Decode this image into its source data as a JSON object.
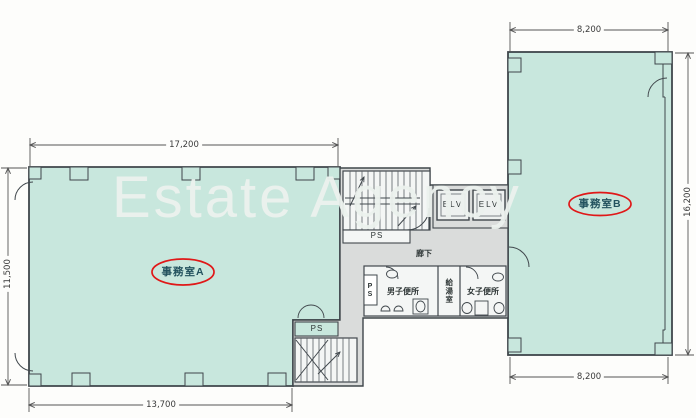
{
  "watermark": {
    "text": "Estate Agency"
  },
  "rooms": {
    "office_a": "事務室A",
    "office_b": "事務室B",
    "corridor": "廊下",
    "mens_toilet": "男子便所",
    "womens_toilet": "女子便所",
    "kitchenette": "給湯室",
    "elevator_1": "ELV",
    "elevator_2": "ELV",
    "pipe_shaft_stair": "PS",
    "pipe_shaft_toilet": "PS",
    "pipe_shaft_lower": "PS"
  },
  "dimensions": {
    "office_a_top_width": "17,200",
    "office_a_bottom_width": "13,700",
    "office_a_left_height": "11,500",
    "office_b_top_width": "8,200",
    "office_b_bottom_width": "8,200",
    "office_b_right_height": "16,200"
  },
  "colors": {
    "room_fill": "#c8e7dd",
    "core_fill": "#dadcdb",
    "inner_fill": "#f4f6f5",
    "wall": "#3f464b",
    "dim_line": "#555555",
    "highlight": "#e01818",
    "room_label": "#23525e"
  }
}
